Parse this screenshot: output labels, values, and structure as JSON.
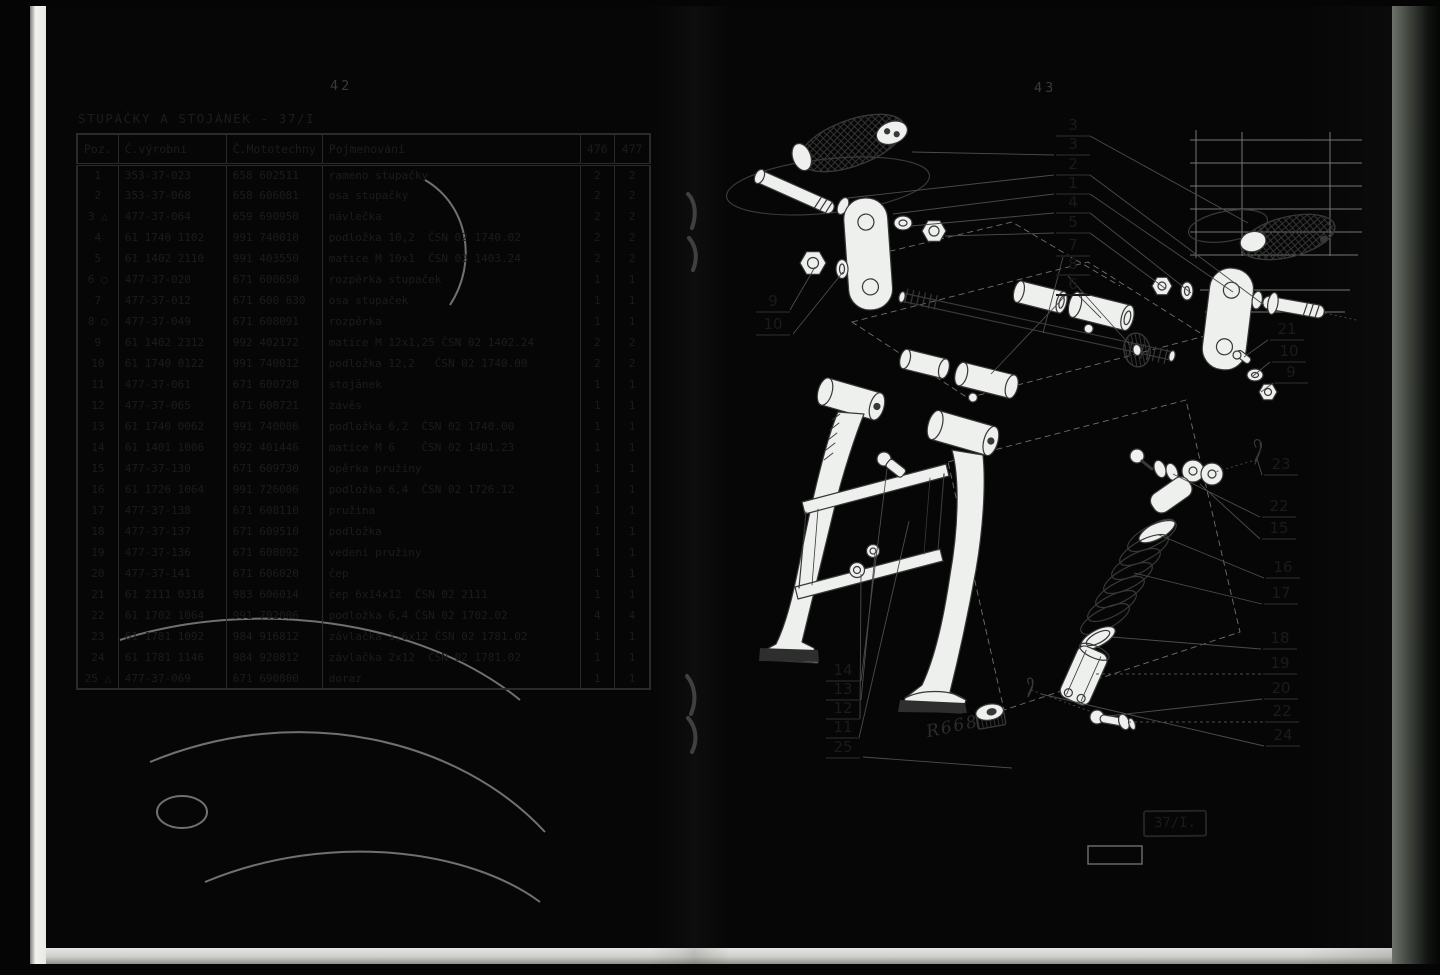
{
  "scan": {
    "left_page": {
      "page_number": "42",
      "section_title": "STUPAČKY A STOJÁNEK - 37/I",
      "table": {
        "headers": [
          "Poz.",
          "Č.výrobní",
          "Č.Mototechny",
          "Pojmenování",
          "476",
          "477"
        ],
        "rows": [
          [
            "1",
            "",
            "353-37-023",
            "658 602511",
            "rameno stupačky",
            "2",
            "2"
          ],
          [
            "2",
            "",
            "353-37-068",
            "658 606081",
            "osa stupačky",
            "2",
            "2"
          ],
          [
            "3",
            "△",
            "477-37-064",
            "659 690950",
            "návlečka",
            "2",
            "2"
          ],
          [
            "4",
            "",
            "61 1740 1102",
            "991 740010",
            "podložka 10,2  ČSN 02 1740.02",
            "2",
            "2"
          ],
          [
            "5",
            "",
            "61 1402 2110",
            "991 403550",
            "matice M 10x1  ČSN 02 1403.24",
            "2",
            "2"
          ],
          [
            "6",
            "○",
            "477-37-020",
            "671 600650",
            "rozpěrka stupaček",
            "1",
            "1"
          ],
          [
            "7",
            "",
            "477-37-012",
            "671 600 630",
            "osa stupaček",
            "1",
            "1"
          ],
          [
            "8",
            "○",
            "477-37-049",
            "671 608091",
            "rozpěrka",
            "1",
            "1"
          ],
          [
            "9",
            "",
            "61 1402 2312",
            "992 402172",
            "matice M 12x1,25 ČSN 02 1402.24",
            "2",
            "2"
          ],
          [
            "10",
            "",
            "61 1740 0122",
            "991 740012",
            "podložka 12,2   ČSN 02 1740.00",
            "2",
            "2"
          ],
          [
            "11",
            "",
            "477-37-061",
            "671 600720",
            "stojánek",
            "1",
            "1"
          ],
          [
            "12",
            "",
            "477-37-065",
            "671 600721",
            "závěs",
            "1",
            "1"
          ],
          [
            "13",
            "",
            "61 1740 0062",
            "991 740006",
            "podložka 6,2  ČSN 02 1740.00",
            "1",
            "1"
          ],
          [
            "14",
            "",
            "61 1401 1006",
            "992 401446",
            "matice M 6    ČSN 02 1401.23",
            "1",
            "1"
          ],
          [
            "15",
            "",
            "477-37-130",
            "671 609730",
            "opěrka pružiny",
            "1",
            "1"
          ],
          [
            "16",
            "",
            "61 1726 1064",
            "991 726006",
            "podložka 6,4  ČSN 02 1726.12",
            "1",
            "1"
          ],
          [
            "17",
            "",
            "477-37-138",
            "671 608110",
            "pružina",
            "1",
            "1"
          ],
          [
            "18",
            "",
            "477-37-137",
            "671 609510",
            "podložka",
            "1",
            "1"
          ],
          [
            "19",
            "",
            "477-37-136",
            "671 608092",
            "vedení pružiny",
            "1",
            "1"
          ],
          [
            "20",
            "",
            "477-37-141",
            "671 606020",
            "čep",
            "1",
            "1"
          ],
          [
            "21",
            "",
            "61 2111 0318",
            "983 606014",
            "čep 6x14x12  ČSN 02 2111",
            "1",
            "1"
          ],
          [
            "22",
            "",
            "61 1702 1064",
            "991 702006",
            "podložka 6,4 ČSN 02 1702.02",
            "4",
            "4"
          ],
          [
            "23",
            "",
            "61 1781 1092",
            "984 916812",
            "závlačka 1,6x12 ČSN 02 1781.02",
            "1",
            "1"
          ],
          [
            "24",
            "",
            "61 1781 1146",
            "984 920812",
            "závlačka 2x12  ČSN 02 1781.02",
            "1",
            "1"
          ],
          [
            "25",
            "△",
            "477-37-069",
            "671 690800",
            "doraz",
            "1",
            "1"
          ]
        ]
      }
    },
    "right_page": {
      "page_number": "43",
      "figure_label": "37/I.",
      "handwritten_note": "R668",
      "callouts": [
        {
          "label": "3",
          "x": 1056,
          "y": 117
        },
        {
          "label": "3",
          "x": 1056,
          "y": 136
        },
        {
          "label": "2",
          "x": 1056,
          "y": 156
        },
        {
          "label": "1",
          "x": 1056,
          "y": 175
        },
        {
          "label": "4",
          "x": 1056,
          "y": 194
        },
        {
          "label": "5",
          "x": 1056,
          "y": 214
        },
        {
          "label": "7",
          "x": 1056,
          "y": 237
        },
        {
          "label": "8",
          "x": 1056,
          "y": 256
        },
        {
          "label": "6",
          "x": 1056,
          "y": 276
        },
        {
          "label": "9",
          "x": 756,
          "y": 293
        },
        {
          "label": "10",
          "x": 756,
          "y": 316
        },
        {
          "label": "14",
          "x": 826,
          "y": 662
        },
        {
          "label": "13",
          "x": 826,
          "y": 681
        },
        {
          "label": "12",
          "x": 826,
          "y": 700
        },
        {
          "label": "11",
          "x": 826,
          "y": 719
        },
        {
          "label": "25",
          "x": 826,
          "y": 739
        },
        {
          "label": "21",
          "x": 1270,
          "y": 321
        },
        {
          "label": "10",
          "x": 1272,
          "y": 343
        },
        {
          "label": "9",
          "x": 1274,
          "y": 364
        },
        {
          "label": "23",
          "x": 1264,
          "y": 456
        },
        {
          "label": "22",
          "x": 1262,
          "y": 498
        },
        {
          "label": "15",
          "x": 1262,
          "y": 520
        },
        {
          "label": "16",
          "x": 1266,
          "y": 559
        },
        {
          "label": "17",
          "x": 1264,
          "y": 585
        },
        {
          "label": "18",
          "x": 1263,
          "y": 630
        },
        {
          "label": "19",
          "x": 1263,
          "y": 655
        },
        {
          "label": "20",
          "x": 1264,
          "y": 680
        },
        {
          "label": "22",
          "x": 1265,
          "y": 703
        },
        {
          "label": "24",
          "x": 1266,
          "y": 727
        }
      ]
    }
  }
}
